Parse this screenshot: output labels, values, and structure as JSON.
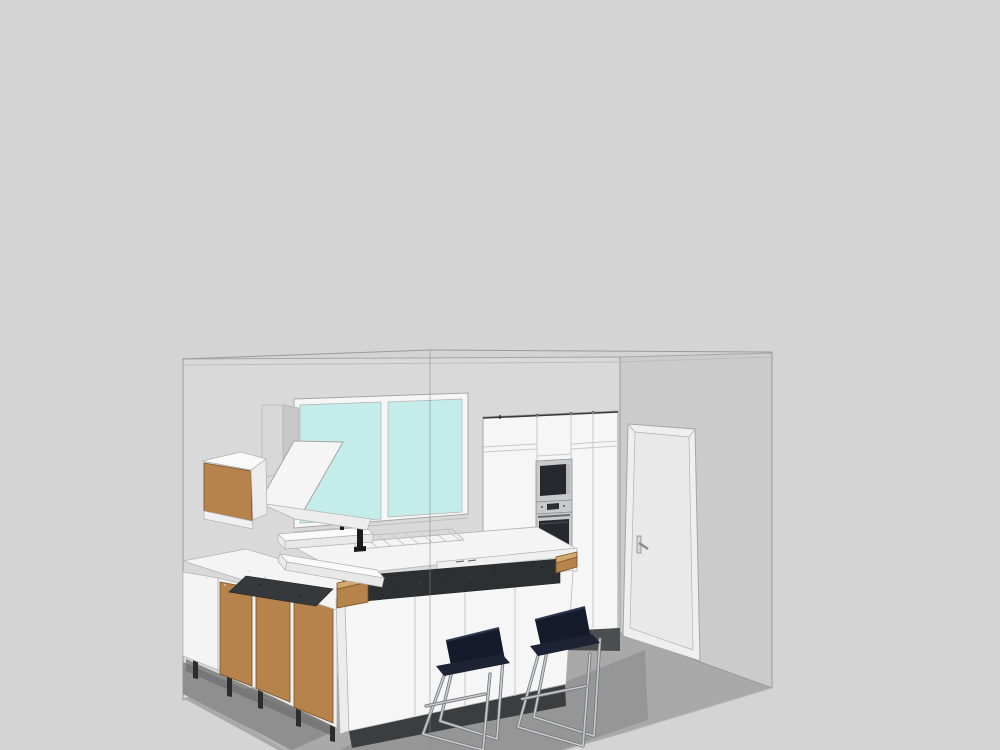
{
  "scene": {
    "description": "3D CAD-style rendering of a kitchen interior with island bar, two bar stools, window, door, built-in oven and microwave",
    "objects": [
      "room shell",
      "window with two glass panes",
      "wood-front wall cabinet",
      "extractor hood with chimney",
      "tall white cabinets",
      "built-in microwave",
      "built-in oven",
      "interior door with handle",
      "sink counter with faucet and drainer",
      "two floating white shelves",
      "dark breakfast bar top with wood end caps",
      "kitchen island with white fronts",
      "dark cooktop",
      "wood-front base cabinets on legs",
      "two navy bar stools with chrome sled legs"
    ]
  },
  "colors": {
    "background": "#d4d4d4",
    "wall_back": "#d9d9d9",
    "wall_right": "#cbcbcb",
    "floor": "#a9a9a9",
    "floor_shadow": "#969696",
    "under_cabinet_shadow": "#8f8f8f",
    "under_cabinet_shadow_dark": "#6f6f6f",
    "dark_kick_band": "#4b4d50",
    "glass": "#c3ecea",
    "white_fixture": "#f6f6f6",
    "white_shaded": "#ececec",
    "white_front": "#f0f0f0",
    "counter": "#f4f4f4",
    "shelf_top": "#fafafa",
    "shelf_front": "#e8e8e8",
    "wood": "#b5834b",
    "wood_light": "#d2a96e",
    "bar_top": "#2c3033",
    "cooktop": "#36393c",
    "appliance_steel": "#c9cacc",
    "appliance_glass": "#25282c",
    "appliance_btn": "#b8b9ba",
    "display_dark": "#2c2f33",
    "plinth": "#3b3d3f",
    "door_face": "#efefef",
    "door_inner": "#e9e9e9",
    "handle_plate": "#d6d6d6",
    "stool_back": "#161b2b",
    "stool_seat": "#1d2335",
    "chrome": "#c9ccd0",
    "leg_dark": "#2c2c2c",
    "faucet": "#1b1b1b",
    "chimney_front": "#d8d8d8",
    "chimney_side": "#c7c7c7",
    "hood_panel": "#f5f5f5",
    "hood_lip": "#ededed"
  }
}
